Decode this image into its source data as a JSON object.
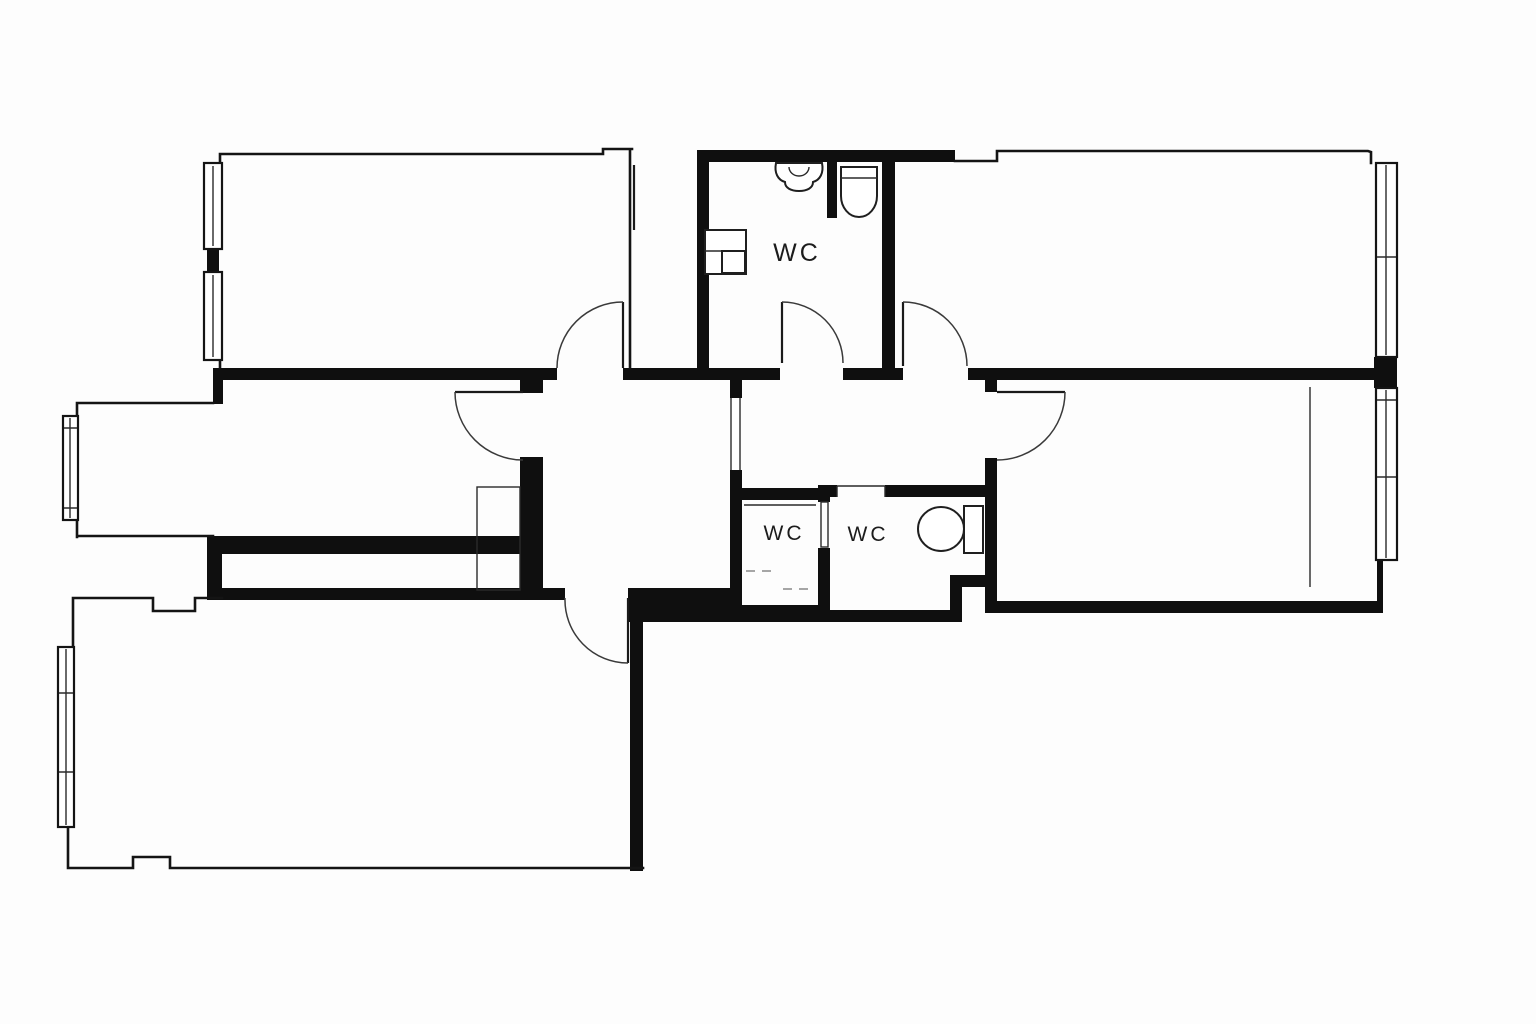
{
  "document": {
    "type": "architectural-floor-plan",
    "background": "#fdfdfd",
    "orientation": "landscape"
  },
  "palette": {
    "wall": "#0f0f0f",
    "line": "#141414",
    "detail": "#3a3a3a",
    "paper": "#fdfdfd"
  },
  "labels": {
    "wc_top": "WC",
    "wc_small": "WC",
    "wc_large": "WC"
  },
  "plan": {
    "rooms": [
      {
        "id": "room-top-left",
        "label": ""
      },
      {
        "id": "closet-strip",
        "label": ""
      },
      {
        "id": "bathroom-top",
        "label": "WC"
      },
      {
        "id": "room-top-right",
        "label": ""
      },
      {
        "id": "room-middle-left",
        "label": ""
      },
      {
        "id": "hall-west",
        "label": ""
      },
      {
        "id": "hall-east",
        "label": ""
      },
      {
        "id": "wc-small",
        "label": "WC"
      },
      {
        "id": "wc-large",
        "label": "WC"
      },
      {
        "id": "room-middle-right",
        "label": ""
      },
      {
        "id": "room-bottom-left",
        "label": ""
      }
    ],
    "fixtures": [
      {
        "name": "sink",
        "room": "bathroom-top"
      },
      {
        "name": "toilet",
        "room": "bathroom-top"
      },
      {
        "name": "washer-counter",
        "room": "bathroom-top"
      },
      {
        "name": "toilet",
        "room": "wc-large"
      }
    ],
    "window_count": 6,
    "door_count": 8
  }
}
